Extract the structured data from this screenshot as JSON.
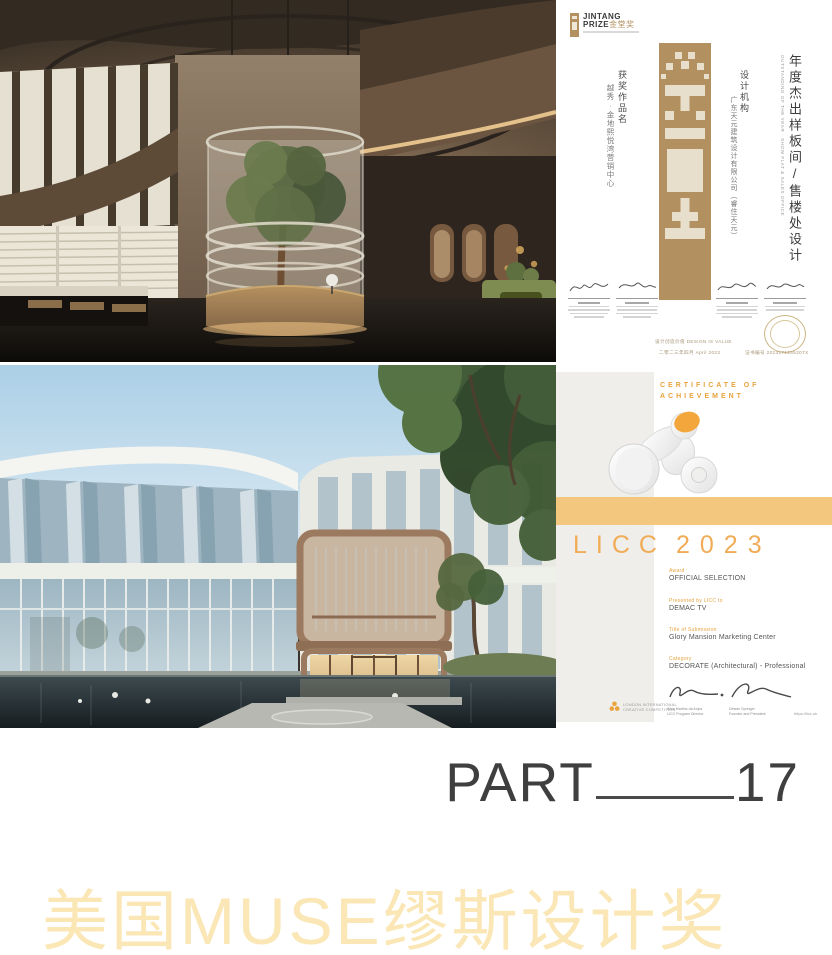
{
  "page": {
    "part": {
      "label": "PART",
      "number": "17"
    },
    "bottom_title": "美国MUSE缪斯设计奖",
    "colors": {
      "gold_title": "#FAE7B5",
      "jintang_gold": "#B3905F",
      "jintang_cream": "#E7DECB",
      "licc_orange": "#E8A33D",
      "licc_band": "#F3C77E",
      "licc_gray_panel": "#EFEEEB"
    },
    "icons": {
      "jintang_logo_icon": "gold-seal-bar",
      "jin_character_bar": "pixel-jin-gold-column",
      "trophy_icon": "white-sculpture-orange-disc",
      "licc_logo_icon": "orange-trefoil",
      "stamp_icon": "gold-ring-seal"
    }
  },
  "jintang": {
    "logo": {
      "line1": "JINTANG",
      "line2": "PRIZE",
      "cn": "金堂奖"
    },
    "award_title_cn": "年度杰出样板间/售楼处设计",
    "award_title_en": "OUTSTANDING OF THE YEAR · SHOW FLAT & SALES OFFICE",
    "work": {
      "label": "获奖作品名",
      "value": "越秀·金地熙悦湾营销中心"
    },
    "agency": {
      "label": "设计机构",
      "value": "广东天元建筑设计有限公司（睿住天元）"
    },
    "footer": {
      "slogan": "设计创造价值 DESIGN IS VALUE",
      "date": "二零二三年四月 April 2023",
      "serial": "证书编号 2023171255207X"
    }
  },
  "licc": {
    "header1": "CERTIFICATE OF",
    "header2": "ACHIEVEMENT",
    "title_word": "LICC",
    "title_year": "2023",
    "award_label": "Award",
    "award_value": "OFFICIAL SELECTION",
    "presented_label": "Presented by LICC to",
    "presented_value": "DEMAC TV",
    "submission_label": "Title of Submission",
    "submission_value": "Glory Mansion Marketing Center",
    "category_label": "Category",
    "category_value": "DECORATE (Architectural) - Professional",
    "sig1_name": "Alice Martins da Anjos",
    "sig1_title": "LICC Program Director",
    "sig2_name": "Dewan Springer",
    "sig2_title": "Founder and President",
    "website": "https://licc.uk",
    "logo_line1": "LONDON INTERNATIONAL",
    "logo_line2": "CREATIVE COMPETITION"
  }
}
